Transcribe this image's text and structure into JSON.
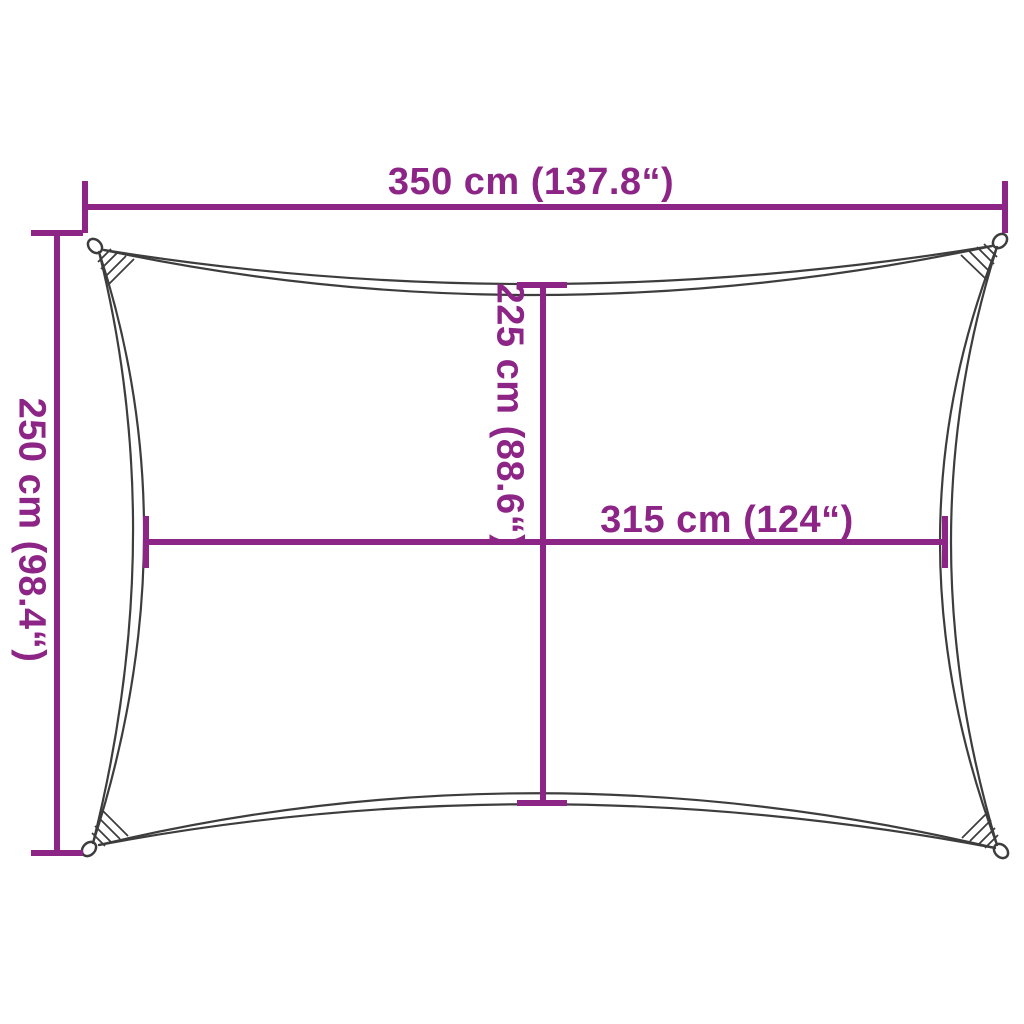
{
  "diagram": {
    "dimensions": {
      "width_top": "350 cm (137.8“)",
      "height_left": "250 cm (98.4“)",
      "inner_height": "225 cm (88.6“)",
      "inner_width": "315 cm (124“)"
    },
    "colors": {
      "dimension_accent": "#8D2587",
      "sail_outline": "#3D3D3D",
      "background": "#FFFFFF"
    }
  }
}
